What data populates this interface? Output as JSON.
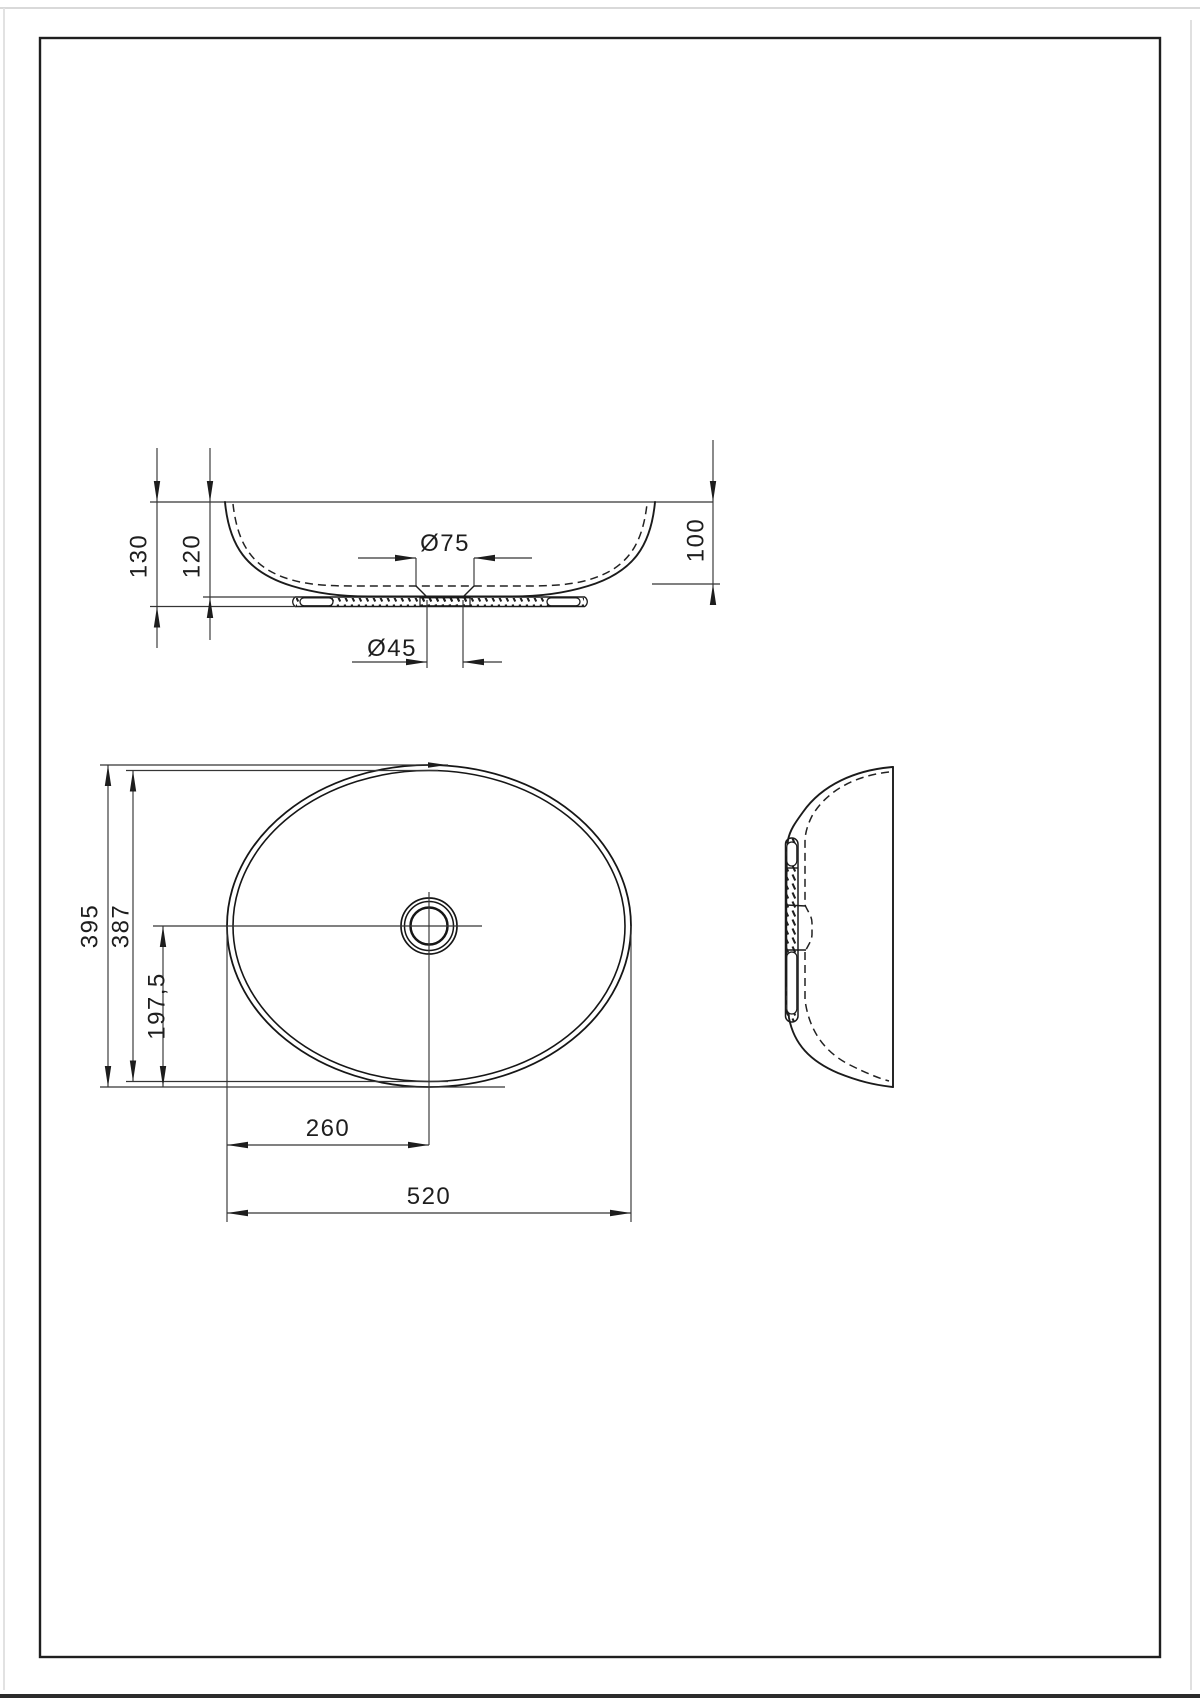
{
  "document": {
    "type": "technical drawing",
    "subject": "oval countertop washbasin - three orthographic views with dimensions",
    "units": "mm",
    "views": {
      "front": {
        "name": "front elevation",
        "dims": [
          {
            "id": "overall-height",
            "label": "130"
          },
          {
            "id": "bowl-height",
            "label": "120"
          },
          {
            "id": "drain-recess-diameter",
            "label": "Ø75"
          },
          {
            "id": "drain-hole-diameter",
            "label": "Ø45"
          },
          {
            "id": "inner-depth",
            "label": "100"
          }
        ]
      },
      "plan": {
        "name": "plan view",
        "dims": [
          {
            "id": "overall-depth",
            "label": "395"
          },
          {
            "id": "inner-depth",
            "label": "387"
          },
          {
            "id": "drain-center-offset",
            "label": "197,5"
          },
          {
            "id": "drain-center-from-edge",
            "label": "260"
          },
          {
            "id": "overall-length",
            "label": "520"
          }
        ]
      },
      "side": {
        "name": "side elevation",
        "dims": []
      }
    },
    "colors": {
      "paper": "#ffffff",
      "frame": "#1f1f1f",
      "object_line": "#1b1b1b",
      "hidden_line": "#222222",
      "dimension_line": "#353535",
      "text": "#1e1e1e"
    }
  }
}
